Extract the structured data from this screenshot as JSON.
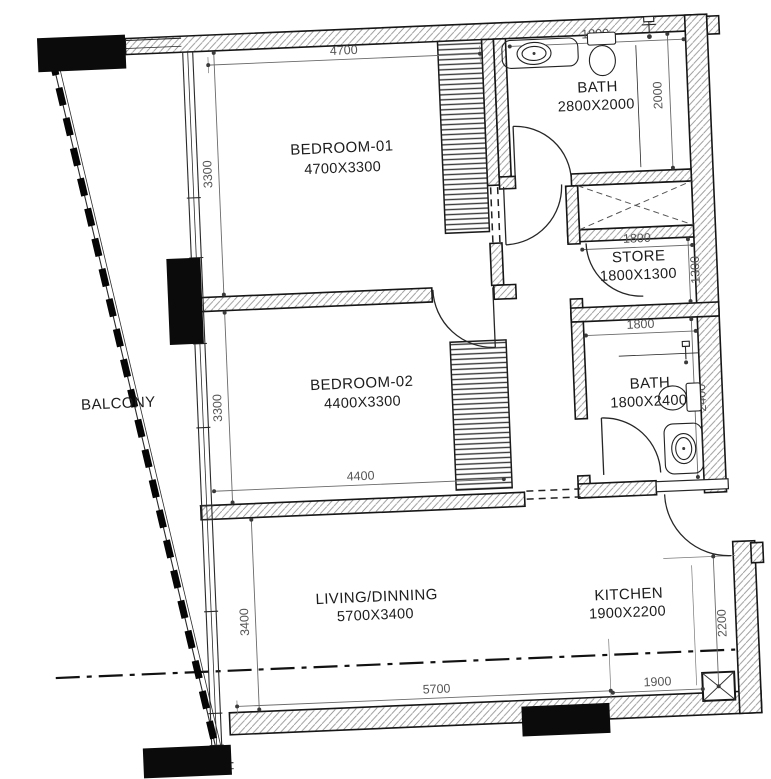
{
  "plan": {
    "background": "#ffffff",
    "line_color": "#161616",
    "dim_color": "#555555",
    "rooms": {
      "bedroom1": {
        "name": "BEDROOM-01",
        "size": "4700X3300"
      },
      "bath1": {
        "name": "BATH",
        "size": "2800X2000"
      },
      "store": {
        "name": "STORE",
        "size": "1800X1300"
      },
      "bath2": {
        "name": "BATH",
        "size": "1800X2400"
      },
      "bedroom2": {
        "name": "BEDROOM-02",
        "size": "4400X3300"
      },
      "living": {
        "name": "LIVING/DINNING",
        "size": "5700X3400"
      },
      "kitchen": {
        "name": "KITCHEN",
        "size": "1900X2200"
      },
      "balcony": {
        "name": "BALCONY"
      }
    },
    "dims": {
      "bd1_w": "4700",
      "bd1_h": "3300",
      "bath1_w": "1800",
      "bath1_h": "2000",
      "store_w": "1800",
      "store_h": "1300",
      "bath2_w": "1800",
      "bath2_h": "2400",
      "bd2_w": "4400",
      "bd2_h": "3300",
      "living_w": "5700",
      "living_h": "3400",
      "kitchen_w": "1900",
      "kitchen_h": "2200"
    }
  }
}
